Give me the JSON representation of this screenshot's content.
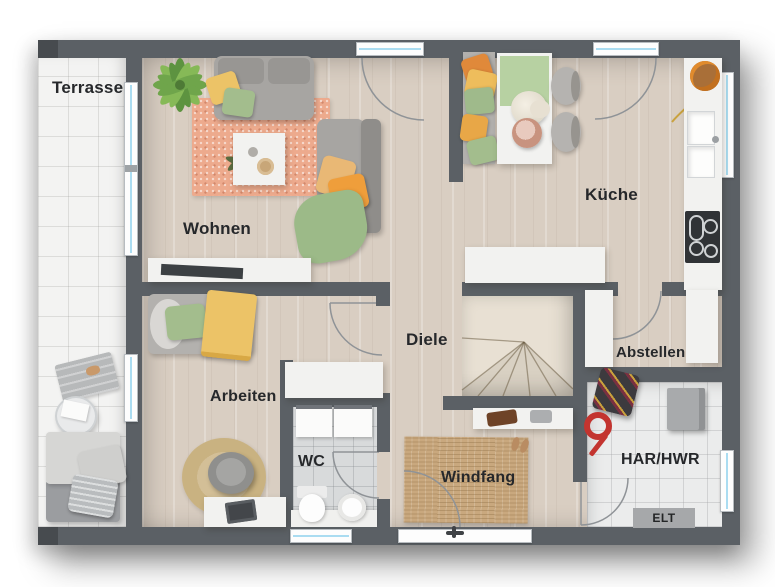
{
  "rooms": {
    "terrasse": "Terrasse",
    "wohnen": "Wohnen",
    "kueche": "Küche",
    "diele": "Diele",
    "arbeiten": "Arbeiten",
    "wc": "WC",
    "windfang": "Windfang",
    "abstellen": "Abstellen",
    "har_hwr": "HAR/HWR",
    "elt": "ELT"
  },
  "colors": {
    "wall": "#5b6065",
    "wall_dark": "#474b4f",
    "floor_wood": "#d9cec2",
    "floor_wood_light": "#e8e0d3",
    "terrace": "#f3f3f2",
    "tile_wc": "#d8dadb",
    "tile_har": "#ebecec",
    "furniture_white": "#f2f2f0",
    "sofa_gray": "#a7a5a2",
    "glass_blue": "#aadcf1",
    "rug_salmon": "#edaa8d",
    "rug_jute": "#c9a87e",
    "pillow_yellow": "#ecc367",
    "pillow_green": "#a3bd8d",
    "pillow_orange": "#ef9e3b",
    "blanket_green": "#9cba88",
    "accent_red": "#c3342f",
    "elt_gray": "#a6a8aa",
    "cooktop_dark": "#303336",
    "label_color": "#26282b"
  }
}
